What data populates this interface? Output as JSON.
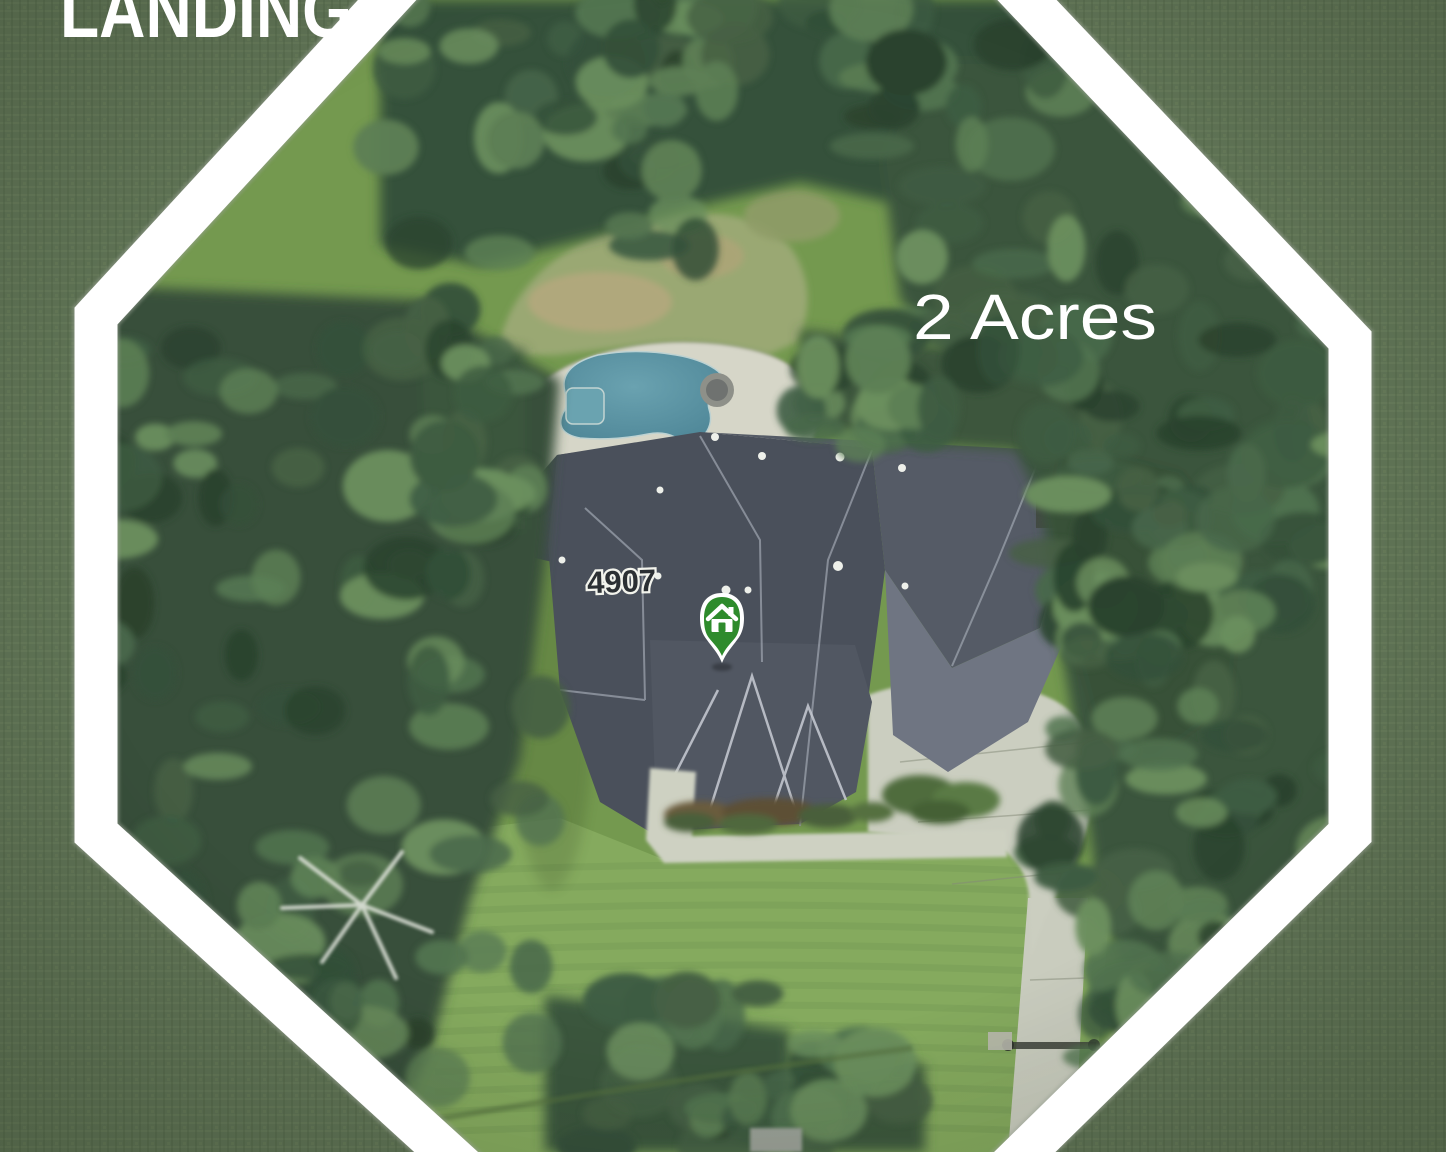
{
  "photo": {
    "type": "aerial-satellite-property-photo",
    "features": [
      "wooded lot",
      "house with pool",
      "curved concrete driveway",
      "large lawn"
    ]
  },
  "labels": {
    "subdivision": "LANDING",
    "acreage": "2 Acres",
    "house_number": "4907"
  },
  "marker": {
    "icon": "home-pin-icon",
    "fill": "#2e8b2c",
    "border": "#ffffff"
  },
  "frame": {
    "shape": "octagon",
    "band_color": "#ffffff",
    "outside_overlay_color": "#5f7355"
  },
  "colors": {
    "label_text": "#ffffff",
    "house_number_fill": "#2b2f33",
    "house_number_halo": "#f2f3ec",
    "pool_water": "#5b93a3",
    "roof": "#4a505b",
    "concrete": "#cbcec0",
    "lawn": "#85aa5e",
    "forest": "#37503a"
  }
}
